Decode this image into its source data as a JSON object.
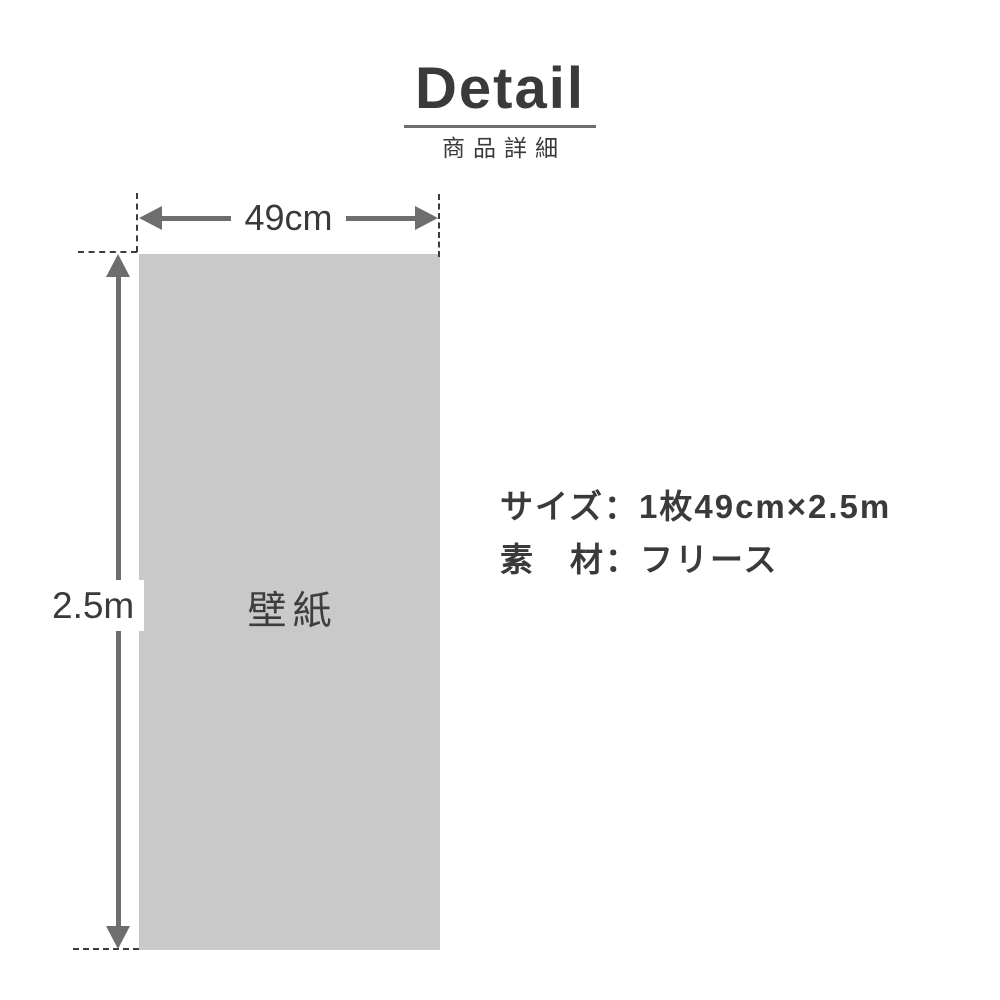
{
  "header": {
    "title": "Detail",
    "subtitle": "商品詳細"
  },
  "diagram": {
    "sheet_label": "壁紙",
    "width_label": "49cm",
    "height_label": "2.5m"
  },
  "specs": {
    "size_line": "サイズ：1枚49cm×2.5m",
    "material_line": "素　材：フリース"
  },
  "colors": {
    "background": "#ffffff",
    "text": "#3a3a3a",
    "sheet_fill": "#c9c9c9",
    "arrow": "#6e6e6e",
    "underline": "#6e6e6e",
    "dashed_line": "#3c3c3c"
  }
}
